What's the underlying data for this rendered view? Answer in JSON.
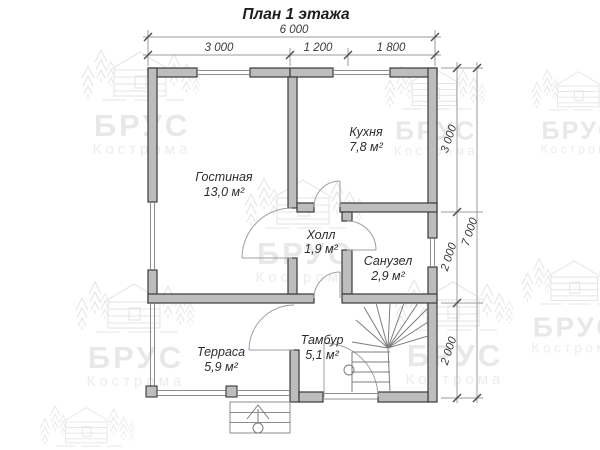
{
  "title": "План 1 этажа",
  "watermark": {
    "brand": "БРУС",
    "city": "Кострома"
  },
  "dimensions": {
    "top_total": "6 000",
    "top_segments": [
      "3 000",
      "1 200",
      "1 800"
    ],
    "right_total": "7 000",
    "right_segments": [
      "3 000",
      "2 000",
      "2 000"
    ]
  },
  "rooms": [
    {
      "name": "Гостиная",
      "area": "13,0 м²"
    },
    {
      "name": "Кухня",
      "area": "7,8 м²"
    },
    {
      "name": "Холл",
      "area": "1,9 м²"
    },
    {
      "name": "Санузел",
      "area": "2,9 м²"
    },
    {
      "name": "Тамбур",
      "area": "5,1 м²"
    },
    {
      "name": "Терраса",
      "area": "5,9 м²"
    }
  ]
}
